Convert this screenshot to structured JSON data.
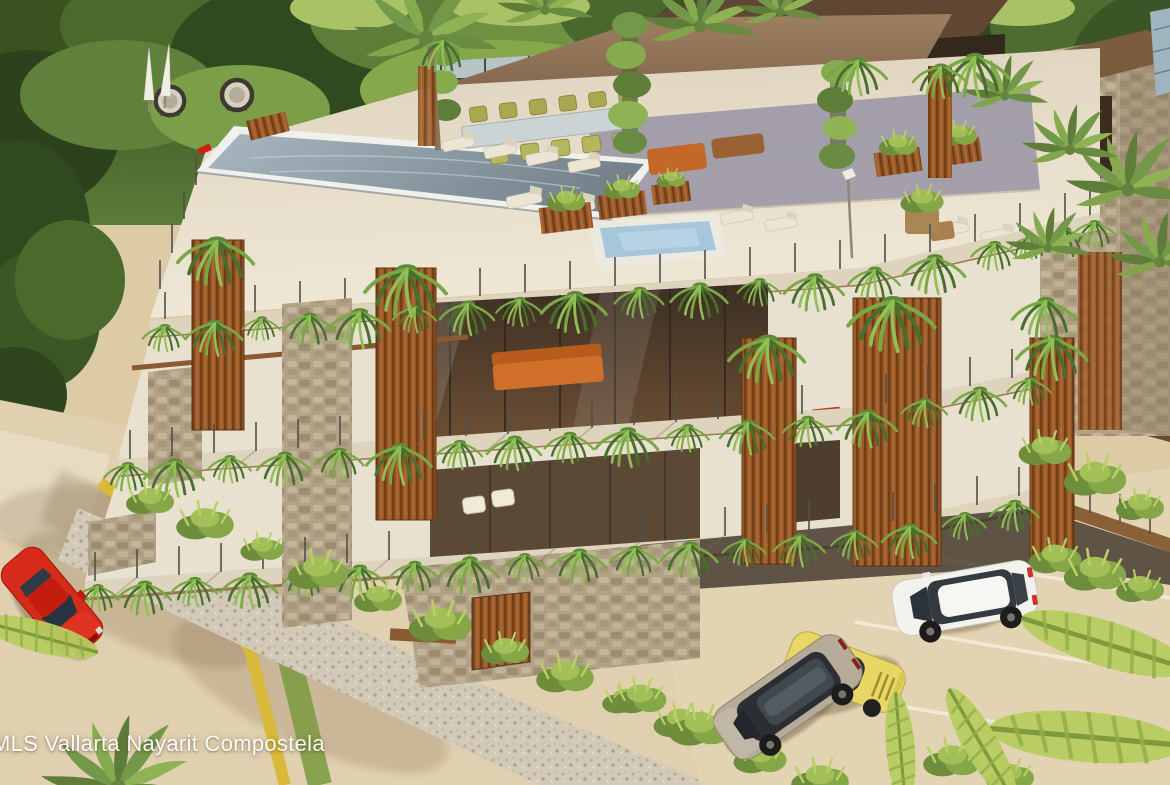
{
  "watermark": {
    "text": "MLS Vallarta Nayarit Compostela"
  },
  "palette": {
    "veg-dark": "#33491f",
    "veg-mid": "#5d7d38",
    "veg-light": "#86ab4e",
    "fern": "#47702c",
    "fern-light": "#79a844",
    "fern-bright": "#92bf55",
    "sand": "#ddcba6",
    "sand-light": "#e7d8b8",
    "gravel": "#d2c9b8",
    "cream": "#e9e1d0",
    "cream-shade": "#d9cfba",
    "deck-shade": "#9d99a7",
    "fascia": "#ded3bd",
    "corten": "#99582a",
    "corten-dark": "#703d17",
    "stone": "#b1a287",
    "roof-brown": "#8d7052",
    "roof-dark": "#5f4733",
    "glass": "#b7c4c6",
    "pool-light": "#a9b8c0",
    "pool-dark": "#75828c",
    "jacuzzi": "#a6c6dc",
    "terracotta": "#bd5f2b",
    "accent-orange": "#c4682a",
    "accent-red": "#b23a22",
    "car-red": "#d62a1a",
    "car-yellow": "#e8d765",
    "car-white": "#f2f2ee",
    "car-gray": "#b6ab99",
    "flower-yellow": "#d9b93a",
    "watermark-white": "#ffffff"
  }
}
